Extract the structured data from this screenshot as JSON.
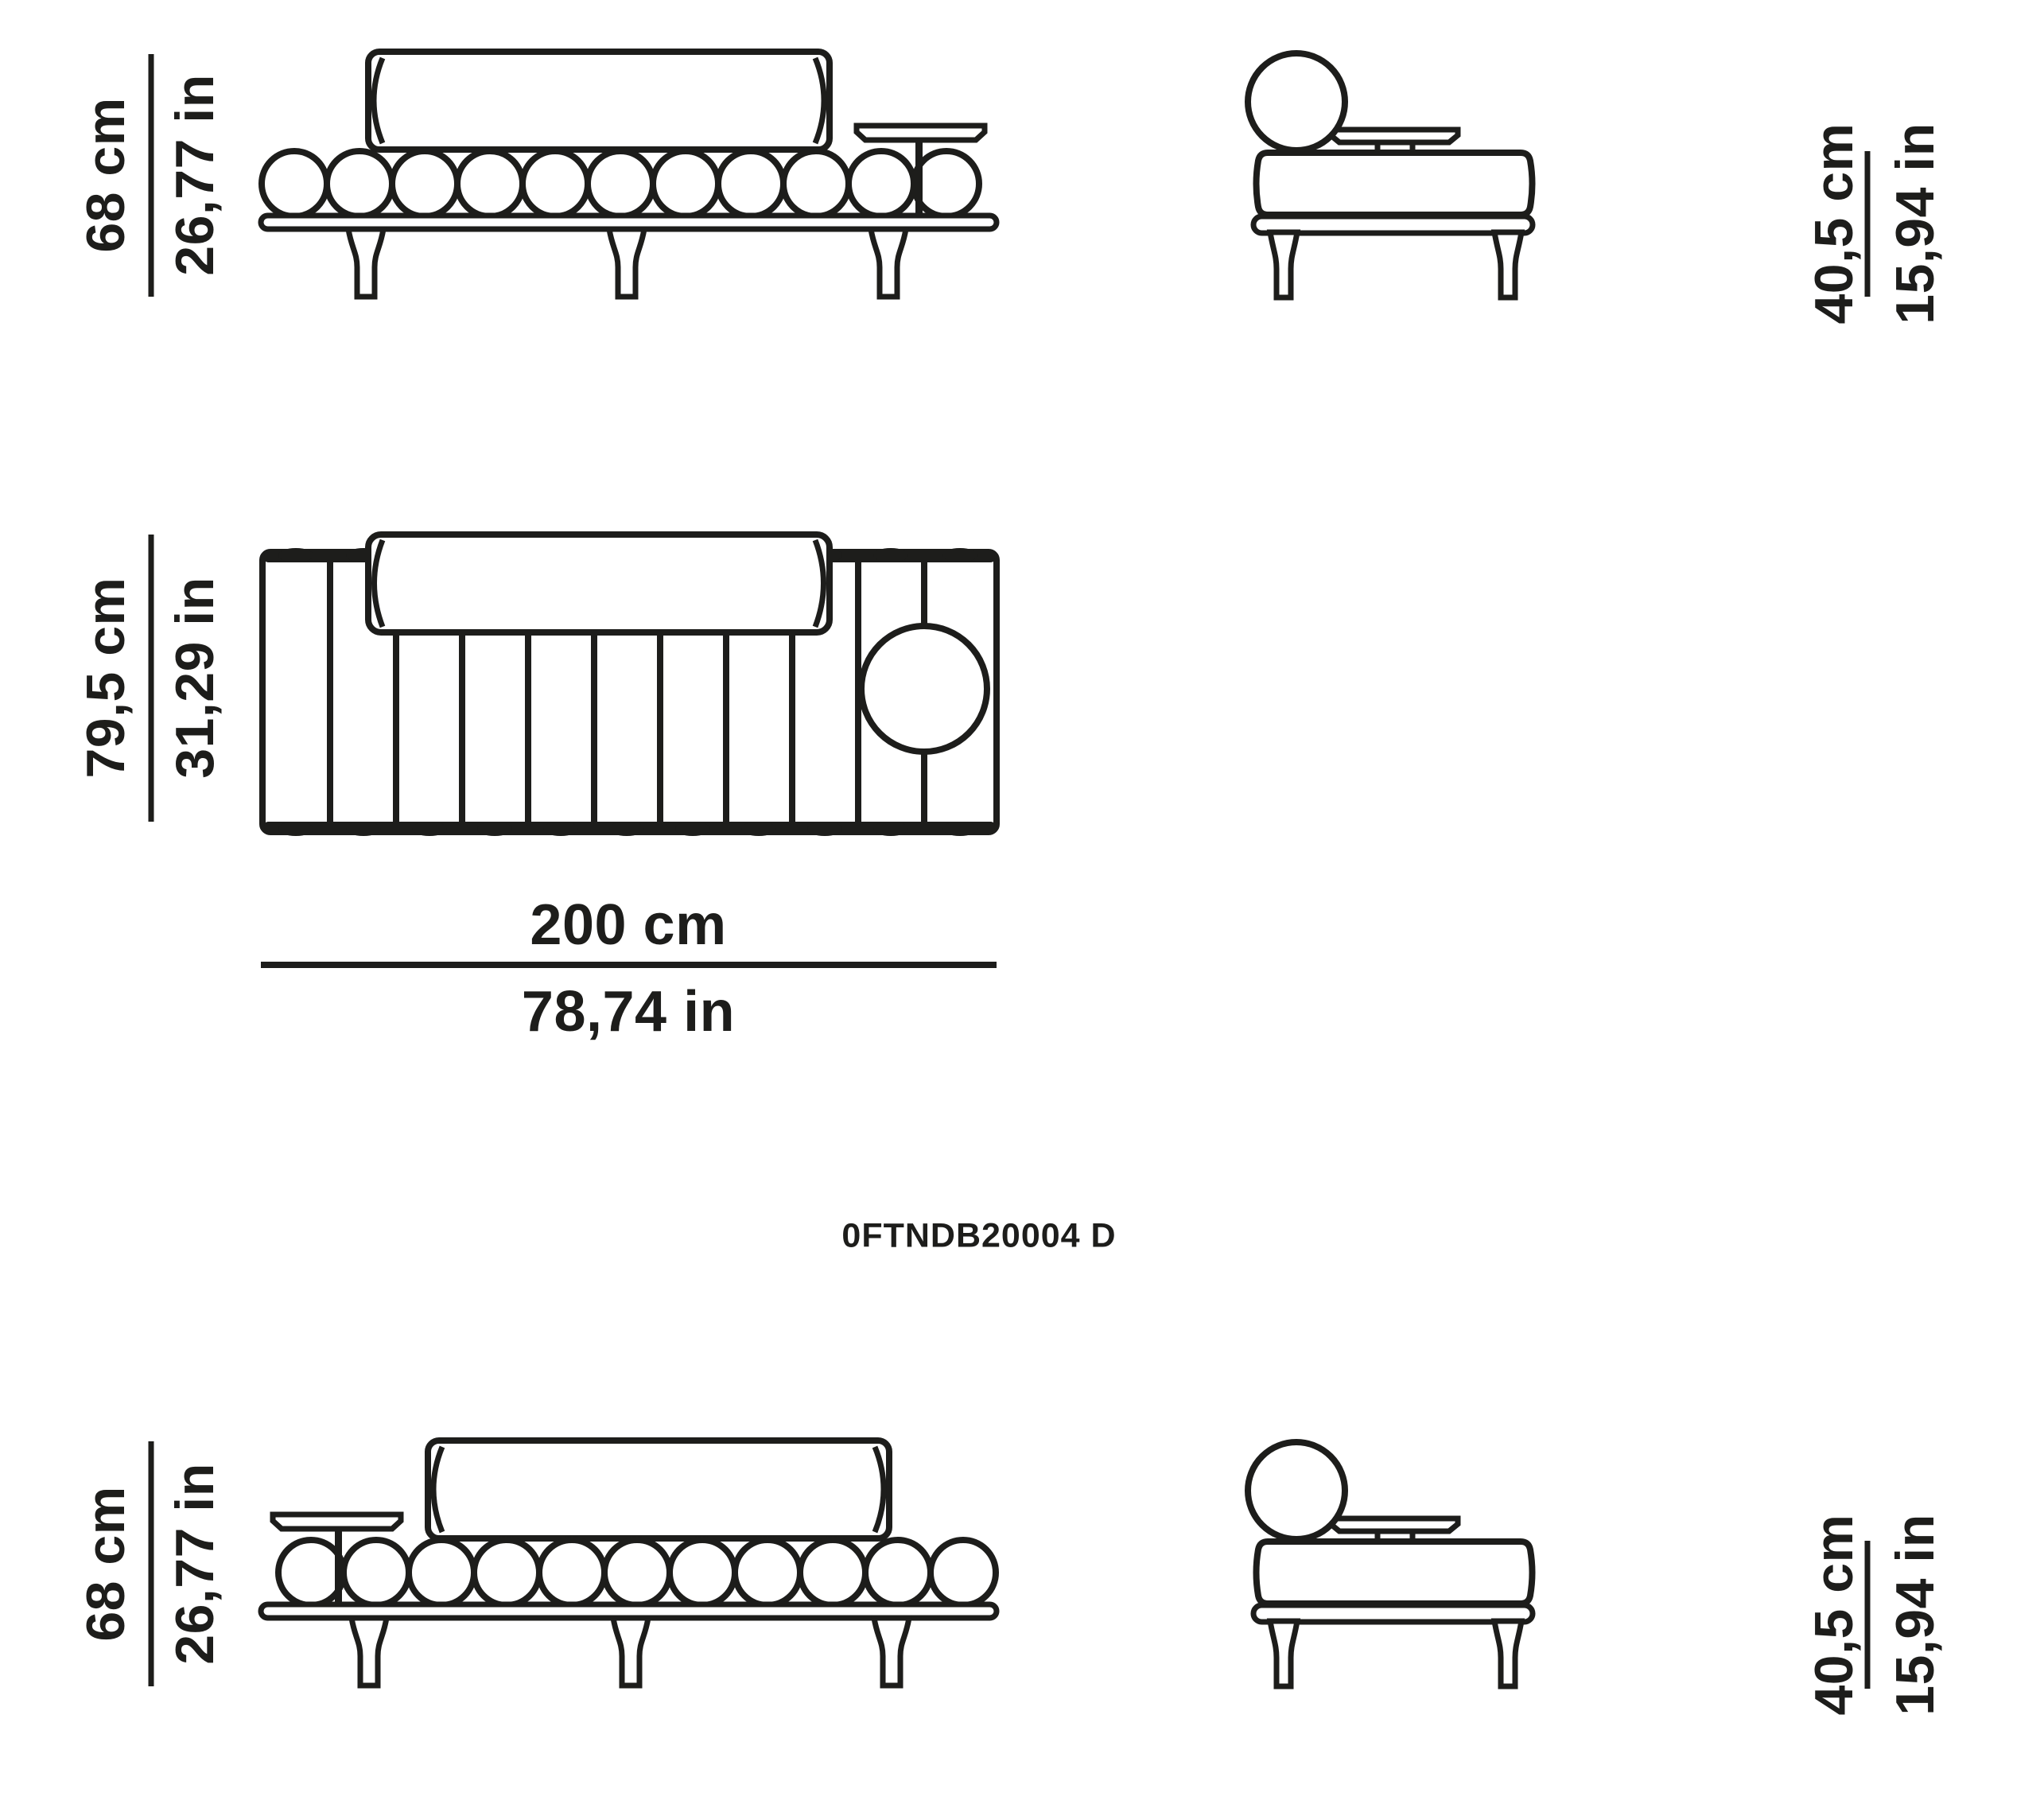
{
  "page": {
    "background_color": "#ffffff",
    "ink_color": "#1d1d1b"
  },
  "product_code": "0FTNDB20004 D",
  "dimensions": {
    "front_height_top": {
      "metric": "68 cm",
      "imperial": "26,77 in"
    },
    "depth": {
      "metric": "79,5 cm",
      "imperial": "31,29 in"
    },
    "width": {
      "metric": "200 cm",
      "imperial": "78,74 in"
    },
    "side_height_top": {
      "metric": "40,5 cm",
      "imperial": "15,94 in"
    },
    "front_height_bottom": {
      "metric": "68 cm",
      "imperial": "26,77 in"
    },
    "side_height_bottom": {
      "metric": "40,5 cm",
      "imperial": "15,94 in"
    }
  }
}
